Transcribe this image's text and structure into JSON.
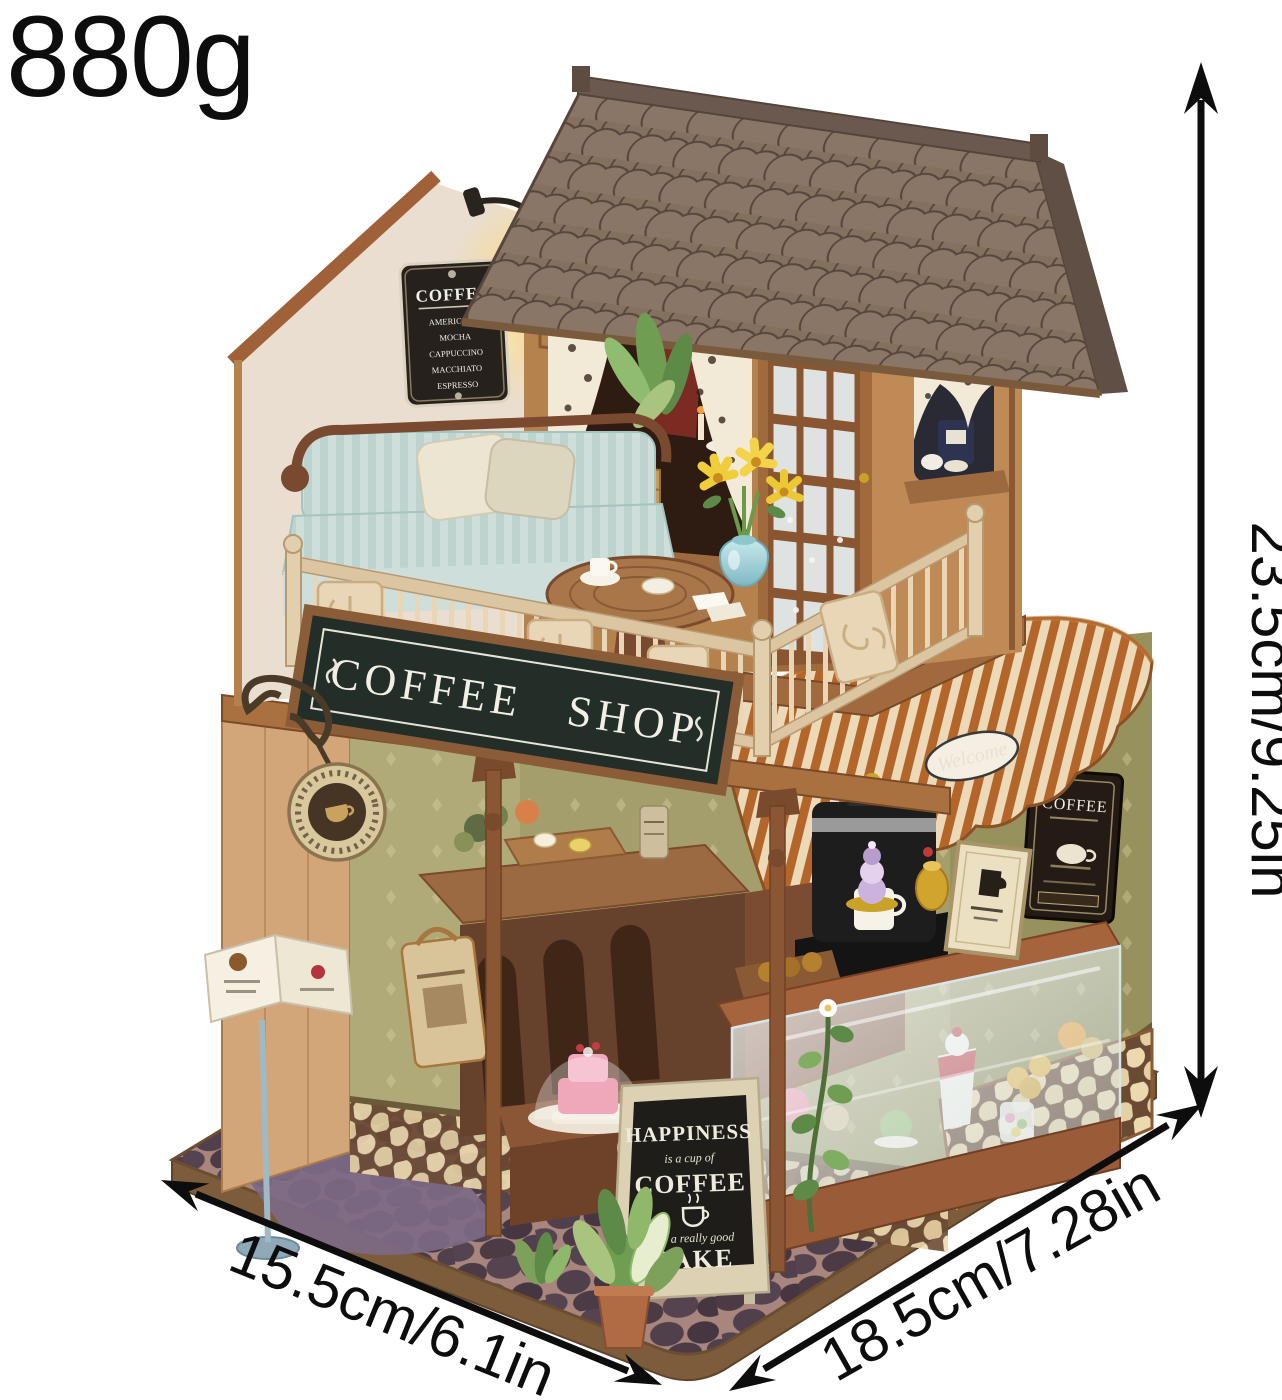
{
  "annotations": {
    "weight": "880g",
    "height": "23.5cm/9.25in",
    "width": "15.5cm/6.1in",
    "depth": "18.5cm/7.28in"
  },
  "signs": {
    "storefront": "COFFEE SHOP",
    "wall_menu": {
      "title": "COFFEE",
      "items": [
        "AMERICANO",
        "MOCHA",
        "CAPPUCCINO",
        "MACCHIATO",
        "ESPRESSO"
      ]
    },
    "sandwich_board": {
      "top": "HAPPINESS",
      "script1": "is a cup of",
      "middle": "COFFEE",
      "script2": "and a really good",
      "bottom": "CAKE"
    },
    "awning_sticker": "Welcome",
    "right_wall_poster": "COFFEE"
  },
  "palette": {
    "sign_board_green": "#232e28",
    "awning_rust": "#b4662a",
    "awning_cream": "#ecd9b8",
    "roof_taupe": "#84705f",
    "wood_frame": "#b5814c",
    "railing_cream": "#e8d6b6",
    "wall_olive": "#a49e6c",
    "base_cobble_stone": "#4c3b45",
    "sofa_blue": "#cddedb",
    "annotation_black": "#0d0d0d"
  }
}
